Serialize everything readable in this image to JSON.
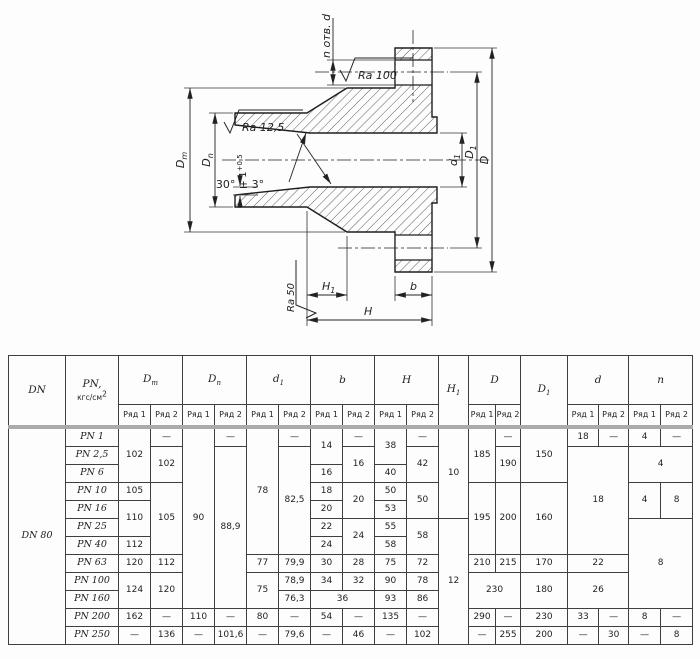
{
  "drawing": {
    "holes_label": "n отв. d",
    "roughness_top": "Ra 100",
    "roughness_bore": "Ra 12,5",
    "roughness_face": "Ra 50",
    "bevel_angle": "30° ± 3°",
    "land": {
      "base": "1",
      "sup": "+0,5"
    },
    "dims": {
      "dm": {
        "base": "D",
        "sub": "m"
      },
      "dn": {
        "base": "D",
        "sub": "n"
      },
      "d1": {
        "base": "d",
        "sub": "1"
      },
      "D1": {
        "base": "D",
        "sub": "1"
      },
      "D": {
        "base": "D"
      },
      "H1": {
        "base": "H",
        "sub": "1"
      },
      "H": {
        "base": "H"
      },
      "b": {
        "base": "b"
      }
    }
  },
  "table": {
    "header_top": [
      {
        "label": "DN",
        "rowspan": 2
      },
      {
        "label": "PN,",
        "label2": "кгс/см",
        "sup": "2",
        "rowspan": 2
      },
      {
        "label": "D",
        "sub": "m",
        "colspan": 2
      },
      {
        "label": "D",
        "sub": "n",
        "colspan": 2
      },
      {
        "label": "d",
        "sub": "1",
        "colspan": 2
      },
      {
        "label": "b",
        "colspan": 2
      },
      {
        "label": "H",
        "colspan": 2
      },
      {
        "label": "H",
        "sub": "1",
        "rowspan": 2
      },
      {
        "label": "D",
        "colspan": 2
      },
      {
        "label": "D",
        "sub": "1",
        "rowspan": 2
      },
      {
        "label": "d",
        "colspan": 2
      },
      {
        "label": "n",
        "colspan": 2
      }
    ],
    "header_ryad": [
      "Ряд 1",
      "Ряд 2",
      "Ряд 1",
      "Ряд 2",
      "Ряд 1",
      "Ряд 2",
      "Ряд 1",
      "Ряд 2",
      "Ряд 1",
      "Ряд 2",
      "Ряд 1",
      "Ряд 2",
      "Ряд 1",
      "Ряд 2",
      "Ряд 1",
      "Ряд 2"
    ],
    "rows": [
      {
        "cells": [
          {
            "v": "DN 80",
            "rs": 12,
            "it": 1,
            "n": "dn-label"
          },
          {
            "v": "PN 1",
            "it": 1,
            "n": "pn-label"
          },
          {
            "v": "102",
            "rs": 3
          },
          {
            "v": "—"
          },
          {
            "v": "90",
            "rs": 10
          },
          {
            "v": "—"
          },
          {
            "v": "78",
            "rs": 7
          },
          {
            "v": "—"
          },
          {
            "v": "14",
            "rs": 2
          },
          {
            "v": "—"
          },
          {
            "v": "38",
            "rs": 2
          },
          {
            "v": "—"
          },
          {
            "v": "10",
            "rs": 5
          },
          {
            "v": "185",
            "rs": 3
          },
          {
            "v": "—"
          },
          {
            "v": "150",
            "rs": 3
          },
          {
            "v": "18"
          },
          {
            "v": "—"
          },
          {
            "v": "4"
          },
          {
            "v": "—"
          }
        ]
      },
      {
        "cells": [
          {
            "v": "PN 2,5",
            "it": 1,
            "n": "pn-label"
          },
          {
            "v": "102",
            "rs": 2
          },
          {
            "v": "88,9",
            "rs": 9
          },
          {
            "v": "82,5",
            "rs": 6
          },
          {
            "v": "16",
            "rs": 2
          },
          {
            "v": "42",
            "rs": 2
          },
          {
            "v": "190",
            "rs": 2
          },
          {
            "v": "18",
            "rs": 6,
            "cs": 2
          },
          {
            "v": "4",
            "rs": 2,
            "cs": 2
          }
        ]
      },
      {
        "cells": [
          {
            "v": "PN 6",
            "it": 1,
            "n": "pn-label"
          },
          {
            "v": "16"
          },
          {
            "v": "40"
          }
        ]
      },
      {
        "cells": [
          {
            "v": "PN 10",
            "it": 1,
            "n": "pn-label"
          },
          {
            "v": "105"
          },
          {
            "v": "105",
            "rs": 4
          },
          {
            "v": "18"
          },
          {
            "v": "20",
            "rs": 2
          },
          {
            "v": "50"
          },
          {
            "v": "50",
            "rs": 2
          },
          {
            "v": "195",
            "rs": 4
          },
          {
            "v": "200",
            "rs": 4
          },
          {
            "v": "160",
            "rs": 4
          },
          {
            "v": "4",
            "rs": 2
          },
          {
            "v": "8",
            "rs": 2
          }
        ]
      },
      {
        "cells": [
          {
            "v": "PN 16",
            "it": 1,
            "n": "pn-label"
          },
          {
            "v": "110",
            "rs": 2
          },
          {
            "v": "20"
          },
          {
            "v": "53"
          }
        ]
      },
      {
        "cells": [
          {
            "v": "PN 25",
            "it": 1,
            "n": "pn-label"
          },
          {
            "v": "22"
          },
          {
            "v": "24",
            "rs": 2
          },
          {
            "v": "55"
          },
          {
            "v": "58",
            "rs": 2
          },
          {
            "v": "12",
            "rs": 7
          },
          {
            "v": "8",
            "rs": 5,
            "cs": 2
          }
        ]
      },
      {
        "cells": [
          {
            "v": "PN 40",
            "it": 1,
            "n": "pn-label"
          },
          {
            "v": "112"
          },
          {
            "v": "24"
          },
          {
            "v": "58"
          }
        ]
      },
      {
        "cells": [
          {
            "v": "PN 63",
            "it": 1,
            "n": "pn-label"
          },
          {
            "v": "120"
          },
          {
            "v": "112"
          },
          {
            "v": "77"
          },
          {
            "v": "79,9"
          },
          {
            "v": "30"
          },
          {
            "v": "28"
          },
          {
            "v": "75"
          },
          {
            "v": "72"
          },
          {
            "v": "210"
          },
          {
            "v": "215"
          },
          {
            "v": "170"
          },
          {
            "v": "22",
            "cs": 2
          }
        ]
      },
      {
        "cells": [
          {
            "v": "PN 100",
            "it": 1,
            "n": "pn-label"
          },
          {
            "v": "124",
            "rs": 2
          },
          {
            "v": "120",
            "rs": 2
          },
          {
            "v": "75",
            "rs": 2
          },
          {
            "v": "78,9"
          },
          {
            "v": "34"
          },
          {
            "v": "32"
          },
          {
            "v": "90"
          },
          {
            "v": "78"
          },
          {
            "v": "230",
            "rs": 2,
            "cs": 2
          },
          {
            "v": "180",
            "rs": 2
          },
          {
            "v": "26",
            "rs": 2,
            "cs": 2
          }
        ]
      },
      {
        "cells": [
          {
            "v": "PN 160",
            "it": 1,
            "n": "pn-label"
          },
          {
            "v": "76,3"
          },
          {
            "v": "36",
            "cs": 2
          },
          {
            "v": "93"
          },
          {
            "v": "86"
          }
        ]
      },
      {
        "cells": [
          {
            "v": "PN 200",
            "it": 1,
            "n": "pn-label"
          },
          {
            "v": "162"
          },
          {
            "v": "—"
          },
          {
            "v": "110"
          },
          {
            "v": "—"
          },
          {
            "v": "80"
          },
          {
            "v": "—"
          },
          {
            "v": "54"
          },
          {
            "v": "—"
          },
          {
            "v": "135"
          },
          {
            "v": "—"
          },
          {
            "v": "290"
          },
          {
            "v": "—"
          },
          {
            "v": "230"
          },
          {
            "v": "33"
          },
          {
            "v": "—"
          },
          {
            "v": "8"
          },
          {
            "v": "—"
          }
        ]
      },
      {
        "cells": [
          {
            "v": "PN 250",
            "it": 1,
            "n": "pn-label"
          },
          {
            "v": "—"
          },
          {
            "v": "136"
          },
          {
            "v": "—"
          },
          {
            "v": "101,6"
          },
          {
            "v": "—"
          },
          {
            "v": "79,6"
          },
          {
            "v": "—"
          },
          {
            "v": "46"
          },
          {
            "v": "—"
          },
          {
            "v": "102"
          },
          {
            "v": "—"
          },
          {
            "v": "255"
          },
          {
            "v": "200"
          },
          {
            "v": "—"
          },
          {
            "v": "30"
          },
          {
            "v": "—"
          },
          {
            "v": "8"
          }
        ]
      }
    ]
  }
}
